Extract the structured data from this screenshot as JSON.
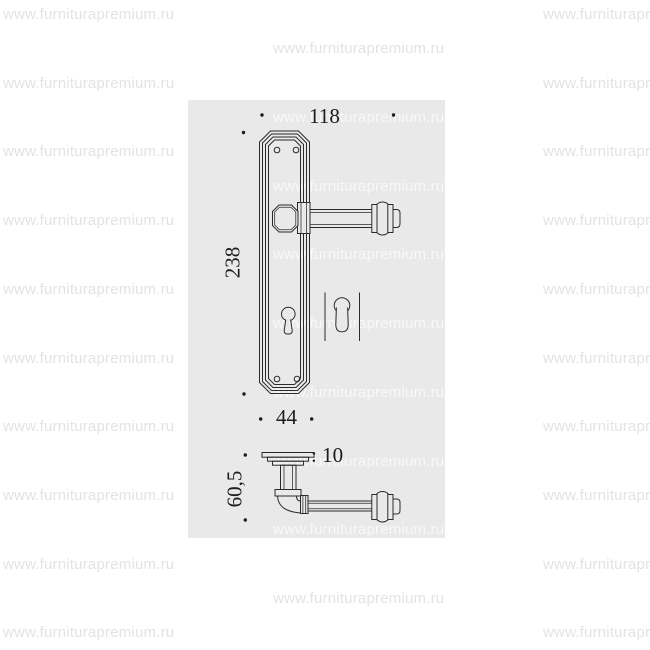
{
  "page": {
    "background": "#ffffff"
  },
  "watermark": {
    "text": "www.furniturapremium.ru",
    "color_on_page": "#e3e3e3",
    "color_on_drawing": "#f8f8f8"
  },
  "drawing": {
    "background": "#e9e9e9",
    "line_color": "#2b2b2b",
    "text_color": "#1c1c1c",
    "dimensions": {
      "top_width": "118",
      "plate_height": "238",
      "plate_width": "44",
      "side_height": "60,5",
      "side_thickness": ": 10"
    }
  }
}
